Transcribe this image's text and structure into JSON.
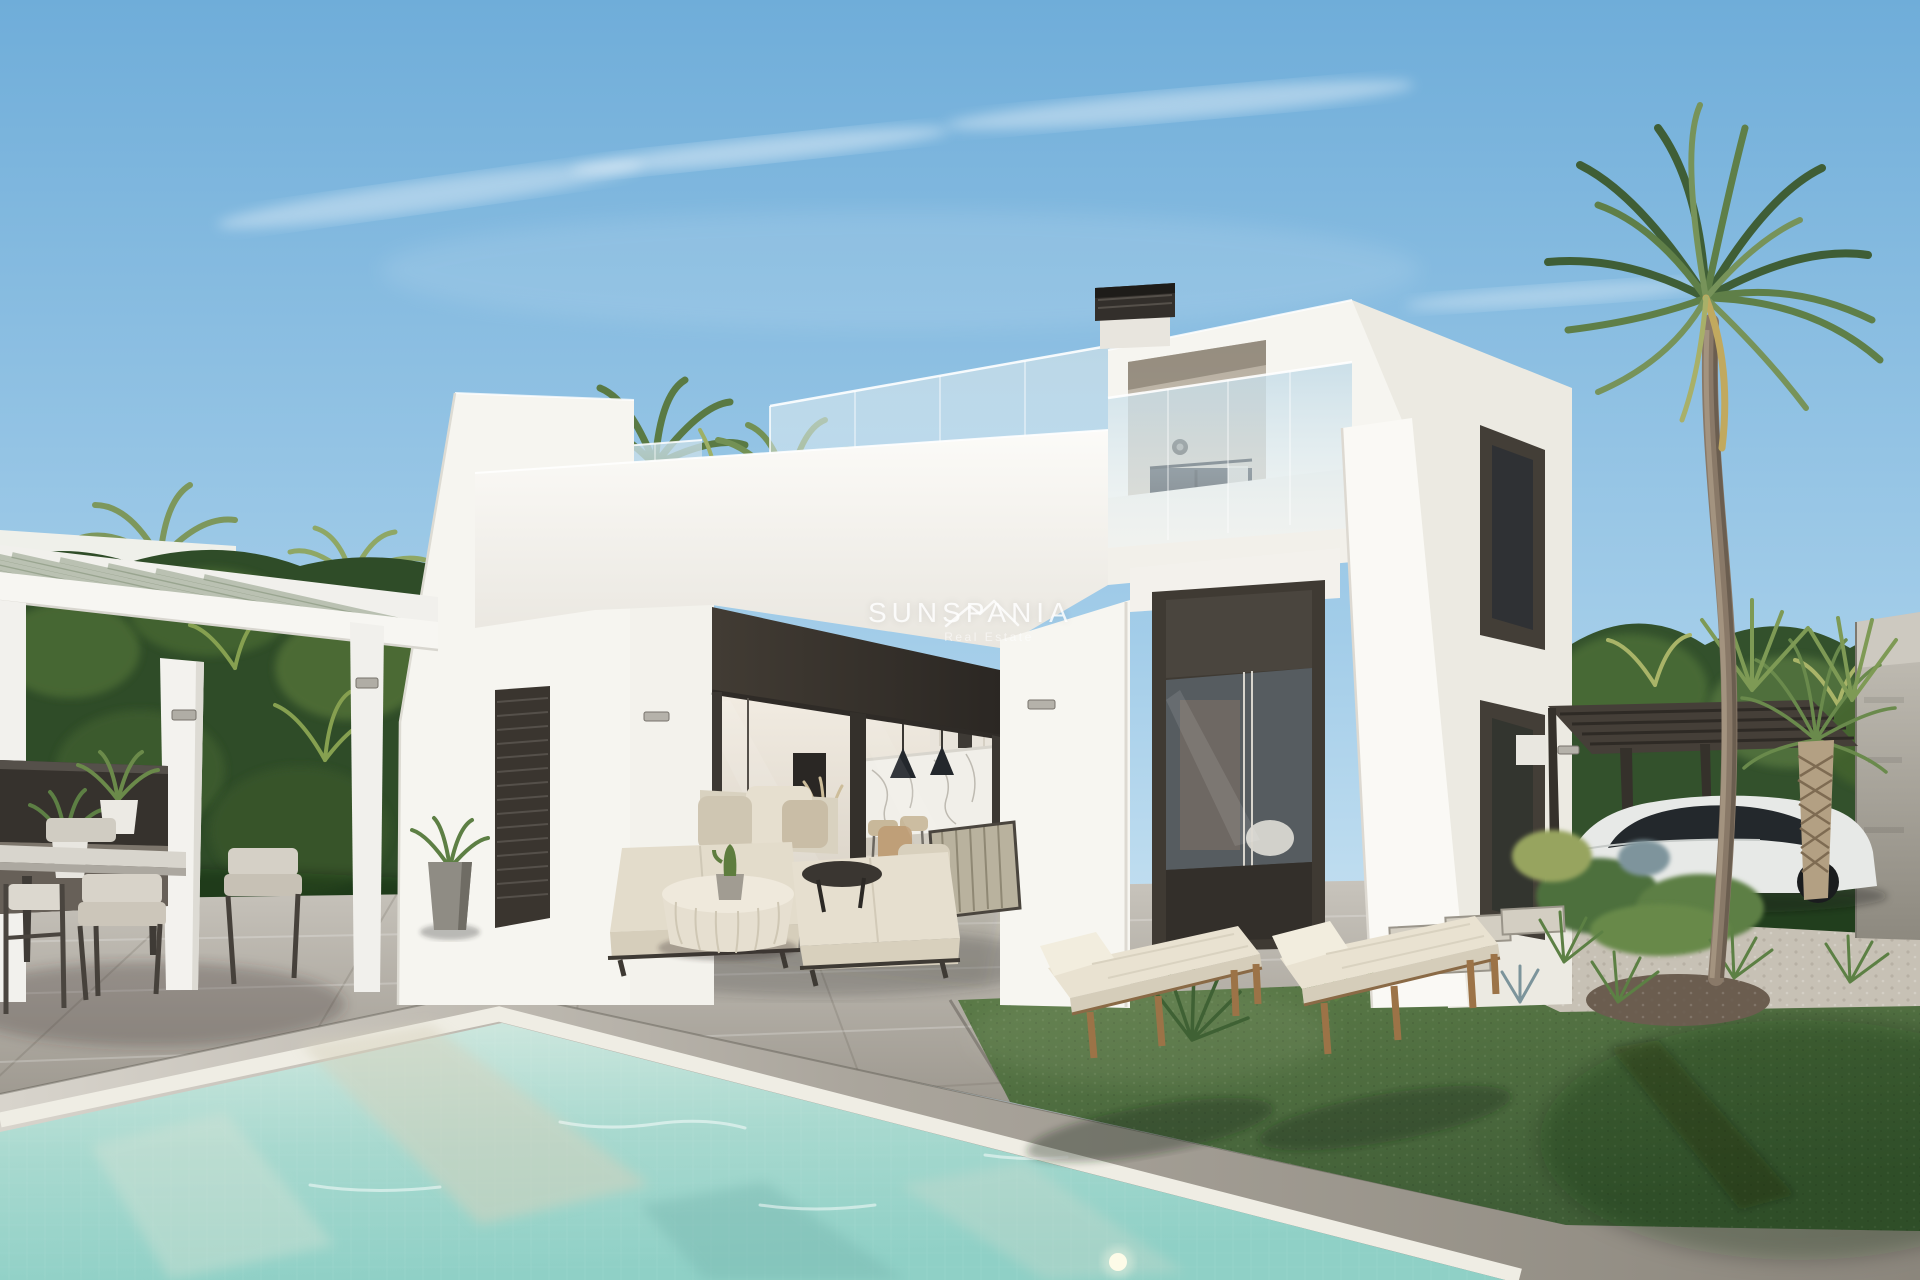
{
  "image_type": "real-estate-3d-render-photo",
  "watermark": {
    "brand": "SUNSPANIA",
    "tagline": "Real Estate"
  },
  "scene": {
    "description": "Modern two-storey white villa with glass-balustrade roof terrace, covered lounge terrace, turquoise private pool, lawn with two sun loungers, white pergola dining area with outdoor kitchen, tropical trees, tall palm, carport with white sports car and concrete gate pillar",
    "objects": [
      "sky",
      "clouds",
      "tropical-hedge",
      "tall-palm-tree",
      "white-villa",
      "glass-balustrade",
      "chimney",
      "balcony-recess",
      "pergola",
      "outdoor-kitchen",
      "dining-set",
      "potted-plants",
      "outdoor-sofa-set",
      "knitted-pouf-table",
      "cactus-pot",
      "swimming-pool",
      "pool-coping",
      "sun-loungers",
      "lawn",
      "gravel-bed",
      "stepping-stones",
      "spiky-plants",
      "dwarf-palm",
      "carport-pergola",
      "white-sports-car",
      "concrete-pillar",
      "interior-kitchen",
      "marble-island",
      "pendant-lamps",
      "bar-stools",
      "wall-lights"
    ]
  },
  "palette": {
    "sky_top": "#74b1dc",
    "sky_horizon": "#d6eaf5",
    "villa_white": "#f6f5f0",
    "villa_shadow": "#e9e7e0",
    "dark_joinery": "#3a342e",
    "glass_tint": "#c9dde8",
    "pool_water": "#9cd4ca",
    "pool_coping": "#8e897f",
    "paving_gray": "#b3aea6",
    "lawn_green": "#53713f",
    "foliage_dark": "#33512c",
    "foliage_light": "#86a050",
    "cushion_beige": "#e3dccb",
    "wood_tan": "#9c7347",
    "concrete_gray": "#a8a49c",
    "car_white": "#e7e9e7",
    "watermark_white": "rgba(255,255,255,0.8)"
  }
}
